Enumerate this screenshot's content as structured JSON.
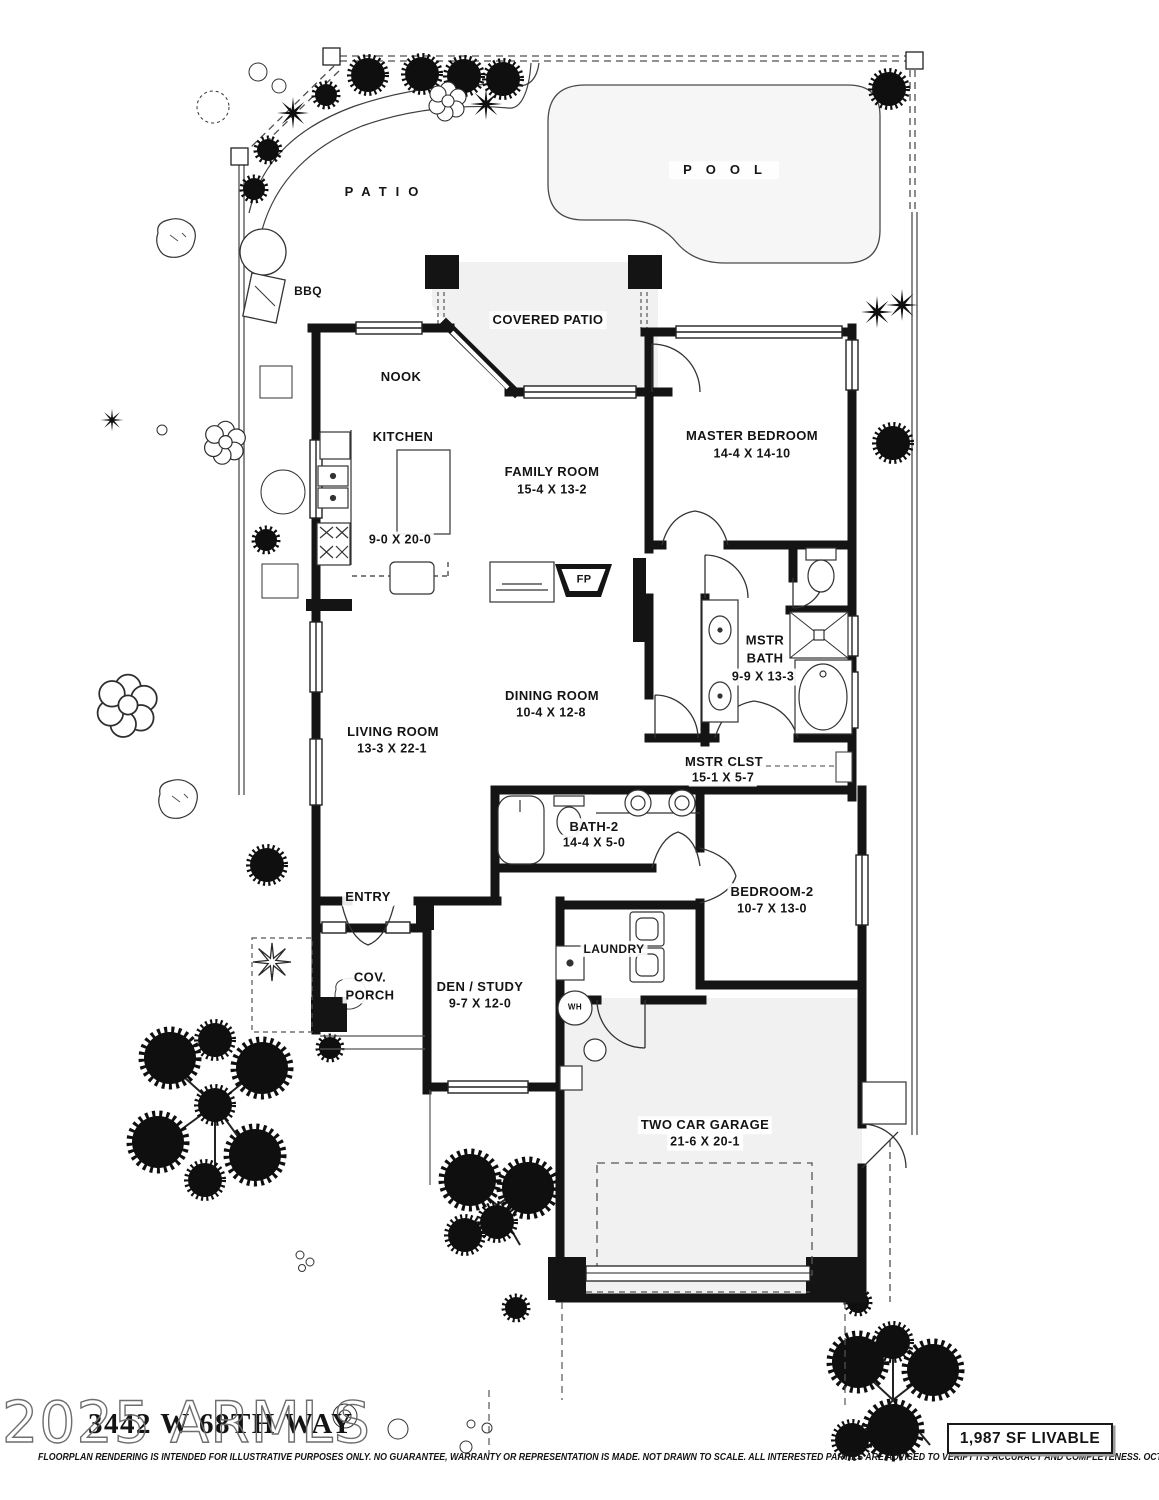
{
  "site": {
    "pool_label": "POOL",
    "patio_label": "PATIO",
    "bbq_label": "BBQ",
    "covered_patio_label": "COVERED PATIO"
  },
  "rooms": {
    "nook": {
      "label": "NOOK"
    },
    "kitchen": {
      "label": "KITCHEN",
      "dims": "9-0 X 20-0"
    },
    "family_room": {
      "label": "FAMILY ROOM",
      "dims": "15-4  X  13-2"
    },
    "master_bedroom": {
      "label": "MASTER BEDROOM",
      "dims": "14-4   X  14-10"
    },
    "master_bath": {
      "label": "MSTR\nBATH",
      "dims": "9-9 X 13-3"
    },
    "dining_room": {
      "label": "DINING ROOM",
      "dims": "10-4  X  12-8"
    },
    "living_room": {
      "label": "LIVING ROOM",
      "dims": "13-3  X  22-1"
    },
    "master_closet": {
      "label": "MSTR  CLST",
      "dims": "15-1  X  5-7"
    },
    "bath_2": {
      "label": "BATH-2",
      "dims": "14-4 X 5-0"
    },
    "bedroom_2": {
      "label": "BEDROOM-2",
      "dims": "10-7  X 13-0"
    },
    "entry": {
      "label": "ENTRY"
    },
    "cov_porch": {
      "label": "COV.\nPORCH"
    },
    "den_study": {
      "label": "DEN / STUDY",
      "dims": "9-7  X  12-0"
    },
    "laundry": {
      "label": "LAUNDRY"
    },
    "water_heater": {
      "label": "WH"
    },
    "fireplace": {
      "label": "FP"
    },
    "garage": {
      "label": "TWO CAR GARAGE",
      "dims": "21-6  X  20-1"
    }
  },
  "footer": {
    "watermark": "2025 ARMLS",
    "address": "3442 W 68TH WAY",
    "disclaimer": "FLOORPLAN RENDERING IS INTENDED FOR ILLUSTRATIVE PURPOSES ONLY.  NO GUARANTEE, WARRANTY OR REPRESENTATION IS MADE.  NOT DRAWN TO SCALE.  ALL INTERESTED PARTIES ARE ADVISED TO VERIFY ITS ACCURACY AND COMPLETENESS.  OCT. 2025.",
    "livable_area": "1,987 SF LIVABLE"
  },
  "colors": {
    "wall": "#141414",
    "room_fill": "#f2f2f2",
    "pool_fill": "#f6f6f6",
    "line": "#3a3a3a"
  }
}
